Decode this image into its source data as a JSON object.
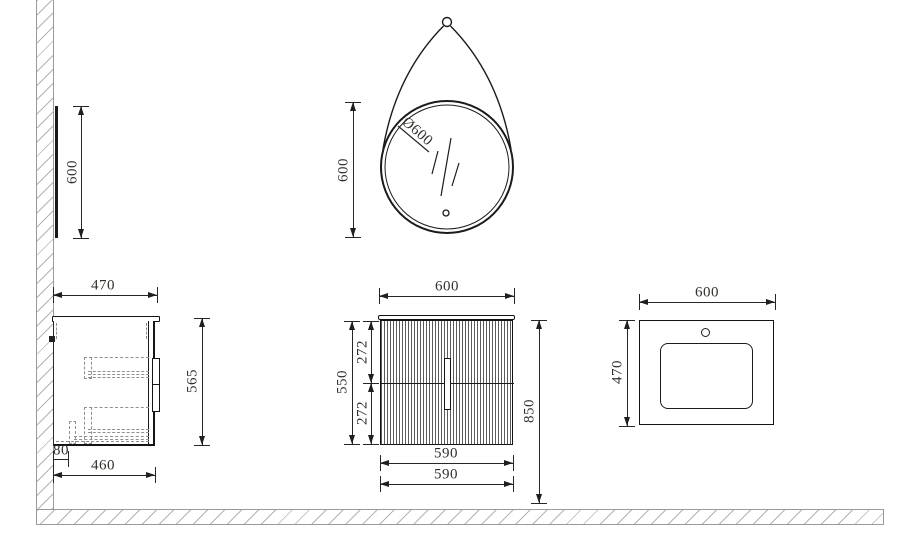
{
  "drawing": {
    "mirror_side": {
      "height": "600"
    },
    "mirror_front": {
      "height": "600",
      "diameter": "Ø600"
    },
    "cabinet_side": {
      "depth_top": "470",
      "height": "565",
      "wall_gap": "80",
      "depth_bottom": "460"
    },
    "cabinet_front": {
      "width": "600",
      "drawer_upper": "272",
      "body_height": "550",
      "drawer_lower": "272",
      "total_height": "850",
      "inner_width_1": "590",
      "inner_width_2": "590"
    },
    "basin_top": {
      "width": "600",
      "depth": "470"
    }
  },
  "colors": {
    "line": "#1a1a1a",
    "hatch": "#b3b3b3",
    "text": "#33302c",
    "background": "#ffffff"
  }
}
